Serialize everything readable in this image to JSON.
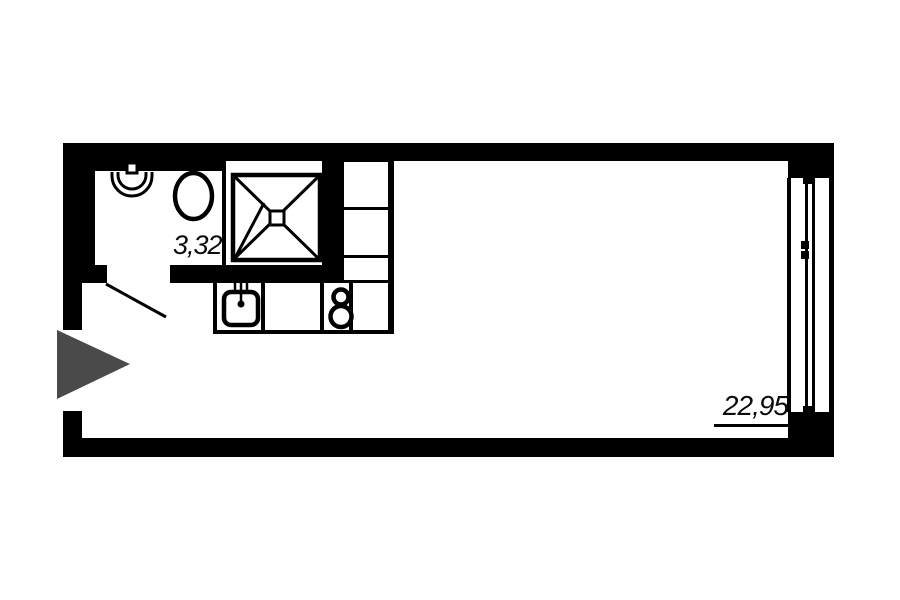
{
  "colors": {
    "background": "#ffffff",
    "walls": "#000000",
    "entrance_arrow": "#4a4a4a"
  },
  "rooms": {
    "bathroom": {
      "area": "3,32"
    },
    "main_room": {
      "area": "22,95"
    }
  },
  "fixtures": [
    "washbasin-icon",
    "toilet-icon",
    "shower-icon",
    "wardrobe-shelves",
    "kitchen-sink-icon",
    "stove-burners-icon",
    "window-glazing",
    "entrance-arrow-icon",
    "door-swing-line"
  ]
}
